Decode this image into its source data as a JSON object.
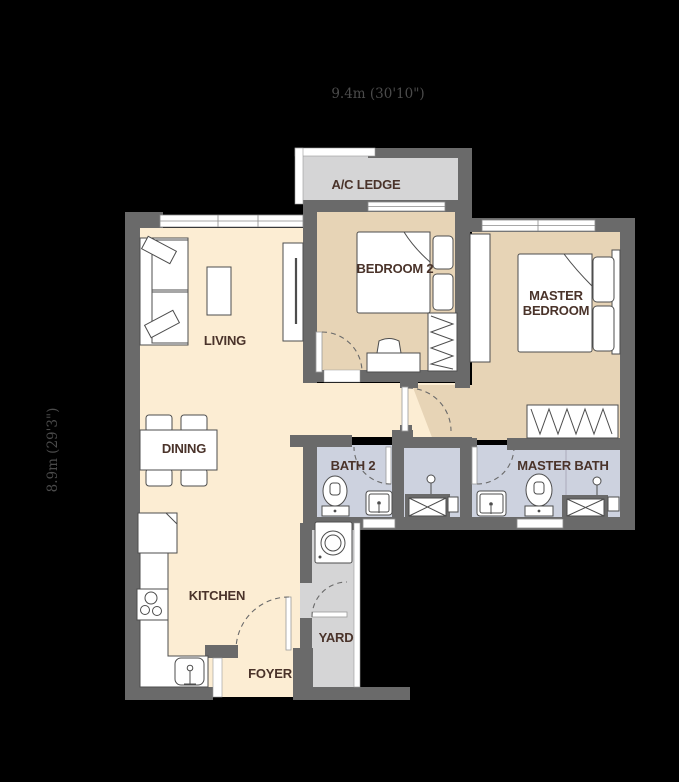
{
  "dimensions": {
    "width_label": "9.4m (30'10\")",
    "height_label": "8.9m (29'3\")"
  },
  "rooms": {
    "ac_ledge": {
      "label": "A/C LEDGE"
    },
    "bedroom2": {
      "label": "BEDROOM 2"
    },
    "master_bedroom": {
      "label": "MASTER BEDROOM",
      "line1": "MASTER",
      "line2": "BEDROOM"
    },
    "living": {
      "label": "LIVING"
    },
    "dining": {
      "label": "DINING"
    },
    "bath2": {
      "label": "BATH 2"
    },
    "master_bath": {
      "label": "MASTER BATH"
    },
    "kitchen": {
      "label": "KITCHEN"
    },
    "yard": {
      "label": "YARD"
    },
    "foyer": {
      "label": "FOYER"
    }
  },
  "colors": {
    "background": "#000000",
    "wall": "#6a6a6a",
    "floor_living": "#fcedd3",
    "floor_bedroom": "#e7d4b6",
    "floor_bath": "#cdd2df",
    "floor_service": "#d5d5d6",
    "label_text": "#4a332a",
    "dimension_text": "#4b4b4b"
  }
}
